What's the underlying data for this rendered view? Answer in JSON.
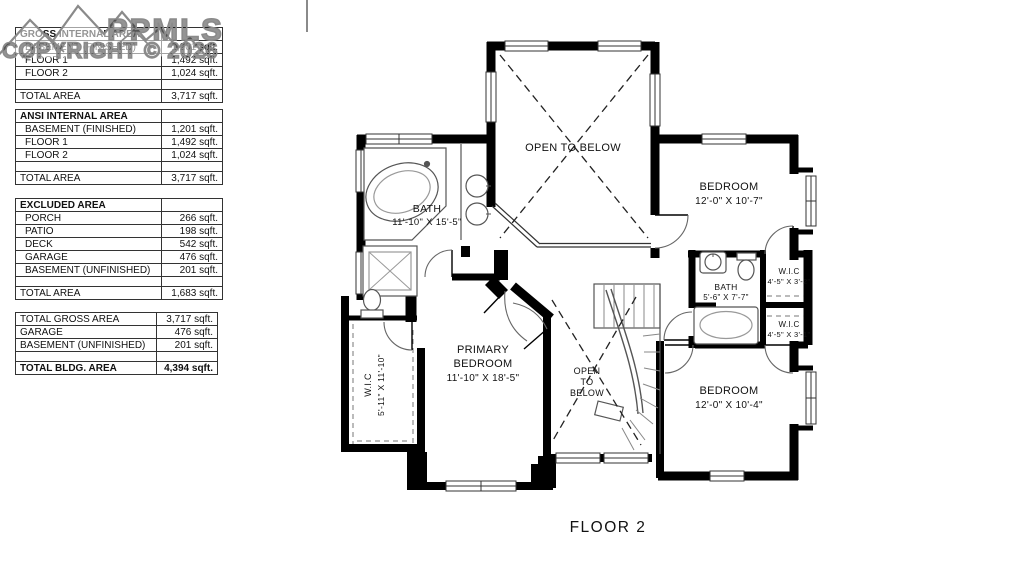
{
  "watermark": {
    "brand": "PPMLS",
    "copyright": "COPYRIGHT © 2026"
  },
  "area_tables": {
    "gross": {
      "header": "GROSS INTERNAL AREA",
      "rows": [
        {
          "label": "BASEMENT (FINISHED)",
          "value": "1,201 sqft."
        },
        {
          "label": "FLOOR 1",
          "value": "1,492 sqft."
        },
        {
          "label": "FLOOR 2",
          "value": "1,024 sqft."
        }
      ],
      "total": {
        "label": "TOTAL AREA",
        "value": "3,717 sqft."
      }
    },
    "ansi": {
      "header": "ANSI INTERNAL AREA",
      "rows": [
        {
          "label": "BASEMENT (FINISHED)",
          "value": "1,201 sqft."
        },
        {
          "label": "FLOOR 1",
          "value": "1,492 sqft."
        },
        {
          "label": "FLOOR 2",
          "value": "1,024 sqft."
        }
      ],
      "total": {
        "label": "TOTAL AREA",
        "value": "3,717 sqft."
      }
    },
    "excluded": {
      "header": "EXCLUDED AREA",
      "rows": [
        {
          "label": "PORCH",
          "value": "266 sqft."
        },
        {
          "label": "PATIO",
          "value": "198 sqft."
        },
        {
          "label": "DECK",
          "value": "542 sqft."
        },
        {
          "label": "GARAGE",
          "value": "476 sqft."
        },
        {
          "label": "BASEMENT (UNFINISHED)",
          "value": "201 sqft."
        }
      ],
      "total": {
        "label": "TOTAL AREA",
        "value": "1,683 sqft."
      }
    },
    "summary": {
      "rows": [
        {
          "label": "TOTAL GROSS AREA",
          "value": "3,717 sqft."
        },
        {
          "label": "GARAGE",
          "value": "476 sqft."
        },
        {
          "label": "BASEMENT (UNFINISHED)",
          "value": "201 sqft."
        }
      ],
      "total": {
        "label": "TOTAL BLDG. AREA",
        "value": "4,394 sqft."
      }
    }
  },
  "plan": {
    "caption": "FLOOR 2",
    "labels": {
      "open_below_top": "OPEN TO BELOW",
      "bedroom_tr_name": "BEDROOM",
      "bedroom_tr_dims": "12'-0\" X 10'-7\"",
      "bath_hall_name": "BATH",
      "bath_hall_dims": "5'-6\" X 7'-7\"",
      "wic_tr_name": "W.I.C",
      "wic_tr_dims": "4'-5\" X 3'-2\"",
      "wic_br_name": "W.I.C",
      "wic_br_dims": "4'-5\" X 3'-1\"",
      "bedroom_br_name": "BEDROOM",
      "bedroom_br_dims": "12'-0\" X 10'-4\"",
      "primary_name1": "PRIMARY",
      "primary_name2": "BEDROOM",
      "primary_dims": "11'-10\" X 18'-5\"",
      "stairs_open1": "OPEN",
      "stairs_open2": "TO",
      "stairs_open3": "BELOW",
      "bath_primary_name": "BATH",
      "bath_primary_dims": "11'-10\" X 15'-5\"",
      "wic_left_name": "W.I.C",
      "wic_left_dims": "5'-11\" X 11'-10\""
    }
  }
}
